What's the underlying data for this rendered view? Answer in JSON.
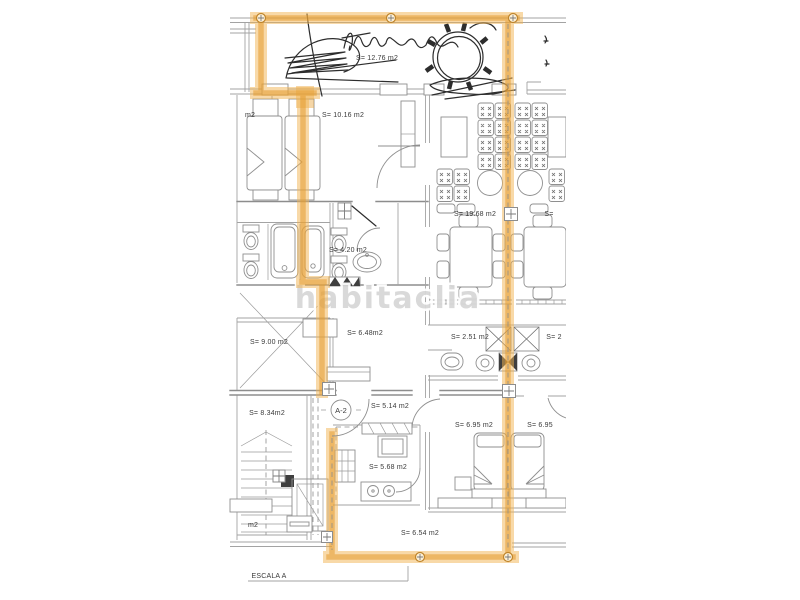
{
  "document": {
    "type": "apartment-floor-plan"
  },
  "watermark": {
    "text": "habitaclia",
    "color": "#d7d7d7"
  },
  "unit": {
    "badge": "A-2"
  },
  "scale": {
    "label": "ESCALA A"
  },
  "colors": {
    "highlight": "#e8a33c",
    "plan_lines": "#8d8d8d",
    "background": "#ffffff"
  },
  "rooms": [
    {
      "name": "terrace-top",
      "label": "S= 12.76 m2"
    },
    {
      "name": "bedroom-1",
      "label": "S= 10.16 m2"
    },
    {
      "name": "bathroom-1",
      "label": "S= 4.20 m2"
    },
    {
      "name": "living-room",
      "label": "S= 19.68 m2"
    },
    {
      "name": "crossed-room",
      "label": "S= 9.00 m2"
    },
    {
      "name": "hall",
      "label": "S= 6.48m2"
    },
    {
      "name": "bathroom-2",
      "label": "S= 2.51 m2"
    },
    {
      "name": "distributor",
      "label": "S= 5.14 m2"
    },
    {
      "name": "stairwell",
      "label": "S= 8.34m2"
    },
    {
      "name": "bedroom-2",
      "label": "S= 6.95 m2"
    },
    {
      "name": "bedroom-right",
      "label": "S= 6.95"
    },
    {
      "name": "kitchen",
      "label": "S= 5.68 m2"
    },
    {
      "name": "terrace-bottom",
      "label": "S= 6.54 m2"
    }
  ],
  "partial_labels": [
    {
      "name": "left-neighbor-top",
      "label": "m2"
    },
    {
      "name": "left-neighbor-bottom",
      "label": "m2"
    },
    {
      "name": "right-neighbor-living",
      "label": "S="
    },
    {
      "name": "right-neighbor-bath",
      "label": "S= 2"
    }
  ]
}
